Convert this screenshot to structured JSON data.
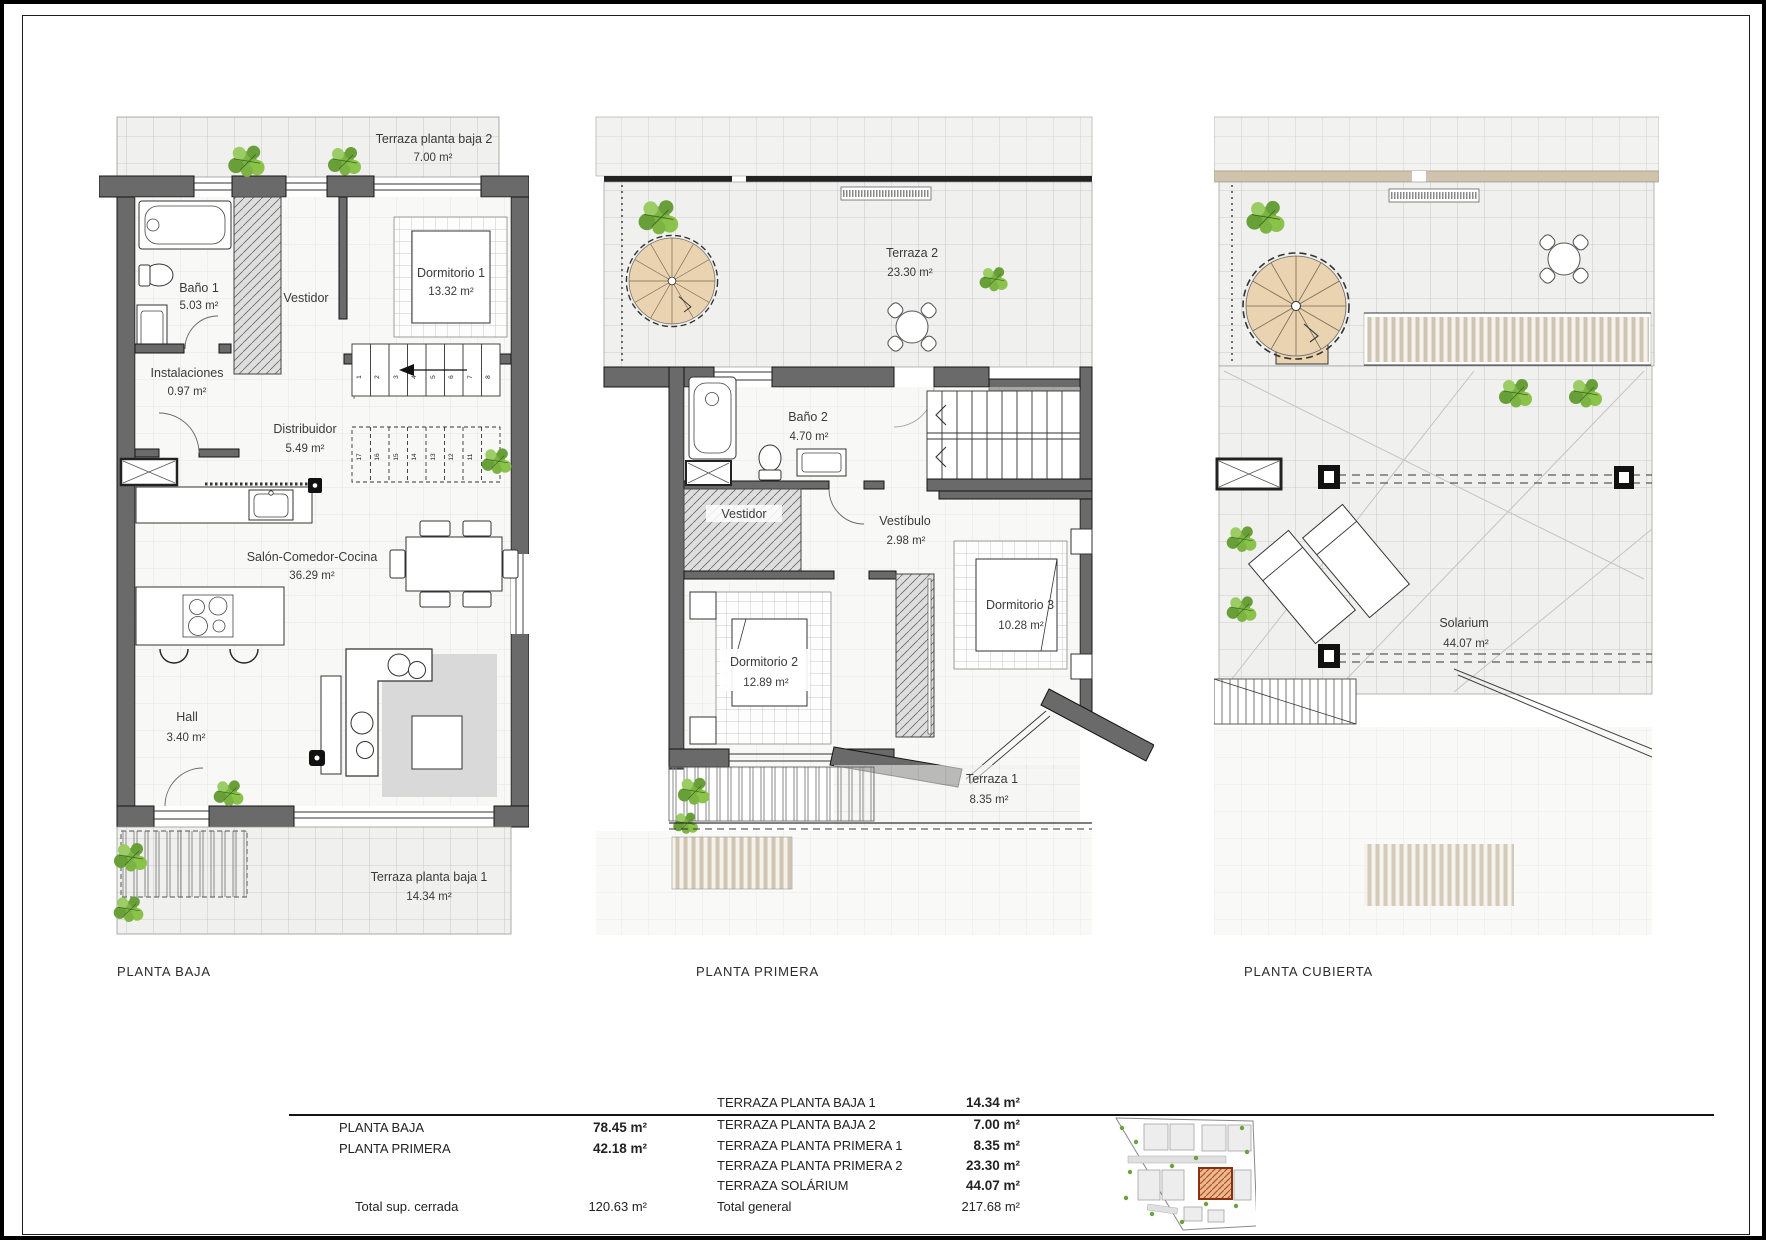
{
  "plan1": {
    "title": "PLANTA BAJA",
    "rooms": {
      "terraza2": {
        "name": "Terraza planta baja 2",
        "area": "7.00 m²"
      },
      "bano1": {
        "name": "Baño 1",
        "area": "5.03 m²"
      },
      "vestidor": {
        "name": "Vestidor"
      },
      "dormitorio1": {
        "name": "Dormitorio 1",
        "area": "13.32 m²"
      },
      "instalaciones": {
        "name": "Instalaciones",
        "area": "0.97 m²"
      },
      "distribuidor": {
        "name": "Distribuidor",
        "area": "5.49 m²"
      },
      "salon": {
        "name": "Salón-Comedor-Cocina",
        "area": "36.29 m²"
      },
      "hall": {
        "name": "Hall",
        "area": "3.40 m²"
      },
      "terraza1": {
        "name": "Terraza planta baja 1",
        "area": "14.34 m²"
      }
    },
    "stairs_up": [
      "1",
      "2",
      "3",
      "4",
      "5",
      "6",
      "7",
      "8"
    ],
    "stairs_down": [
      "17",
      "16",
      "15",
      "14",
      "13",
      "12",
      "11",
      "10"
    ]
  },
  "plan2": {
    "title": "PLANTA PRIMERA",
    "rooms": {
      "terraza2": {
        "name": "Terraza 2",
        "area": "23.30 m²"
      },
      "bano2": {
        "name": "Baño 2",
        "area": "4.70 m²"
      },
      "vestidor": {
        "name": "Vestidor"
      },
      "vestibulo": {
        "name": "Vestíbulo",
        "area": "2.98 m²"
      },
      "dormitorio2": {
        "name": "Dormitorio 2",
        "area": "12.89 m²"
      },
      "dormitorio3": {
        "name": "Dormitorio 3",
        "area": "10.28 m²"
      },
      "terraza1": {
        "name": "Terraza 1",
        "area": "8.35 m²"
      }
    }
  },
  "plan3": {
    "title": "PLANTA CUBIERTA",
    "rooms": {
      "solarium": {
        "name": "Solarium",
        "area": "44.07 m²"
      }
    }
  },
  "summary": {
    "closed": {
      "rows": [
        {
          "label": "PLANTA BAJA",
          "value": "78.45 m²"
        },
        {
          "label": "PLANTA PRIMERA",
          "value": "42.18 m²"
        }
      ],
      "total": {
        "label": "Total sup. cerrada",
        "value": "120.63 m²"
      }
    },
    "terraces": {
      "rows": [
        {
          "label": "TERRAZA PLANTA BAJA 1",
          "value": "14.34 m²"
        },
        {
          "label": "TERRAZA PLANTA BAJA 2",
          "value": "7.00 m²"
        },
        {
          "label": "TERRAZA PLANTA PRIMERA 1",
          "value": "8.35 m²"
        },
        {
          "label": "TERRAZA PLANTA PRIMERA 2",
          "value": "23.30 m²"
        },
        {
          "label": "TERRAZA SOLÁRIUM",
          "value": "44.07 m²"
        }
      ],
      "total": {
        "label": "Total general",
        "value": "217.68 m²"
      }
    }
  },
  "colors": {
    "wall_gray": "#6a6a6a",
    "tile_bg": "#f0f0ee",
    "stair_tan": "#e9d3b1",
    "louver_tan": "#cfc5b2",
    "plant_green": "#7cb342",
    "site_highlight": "#b0541f"
  }
}
